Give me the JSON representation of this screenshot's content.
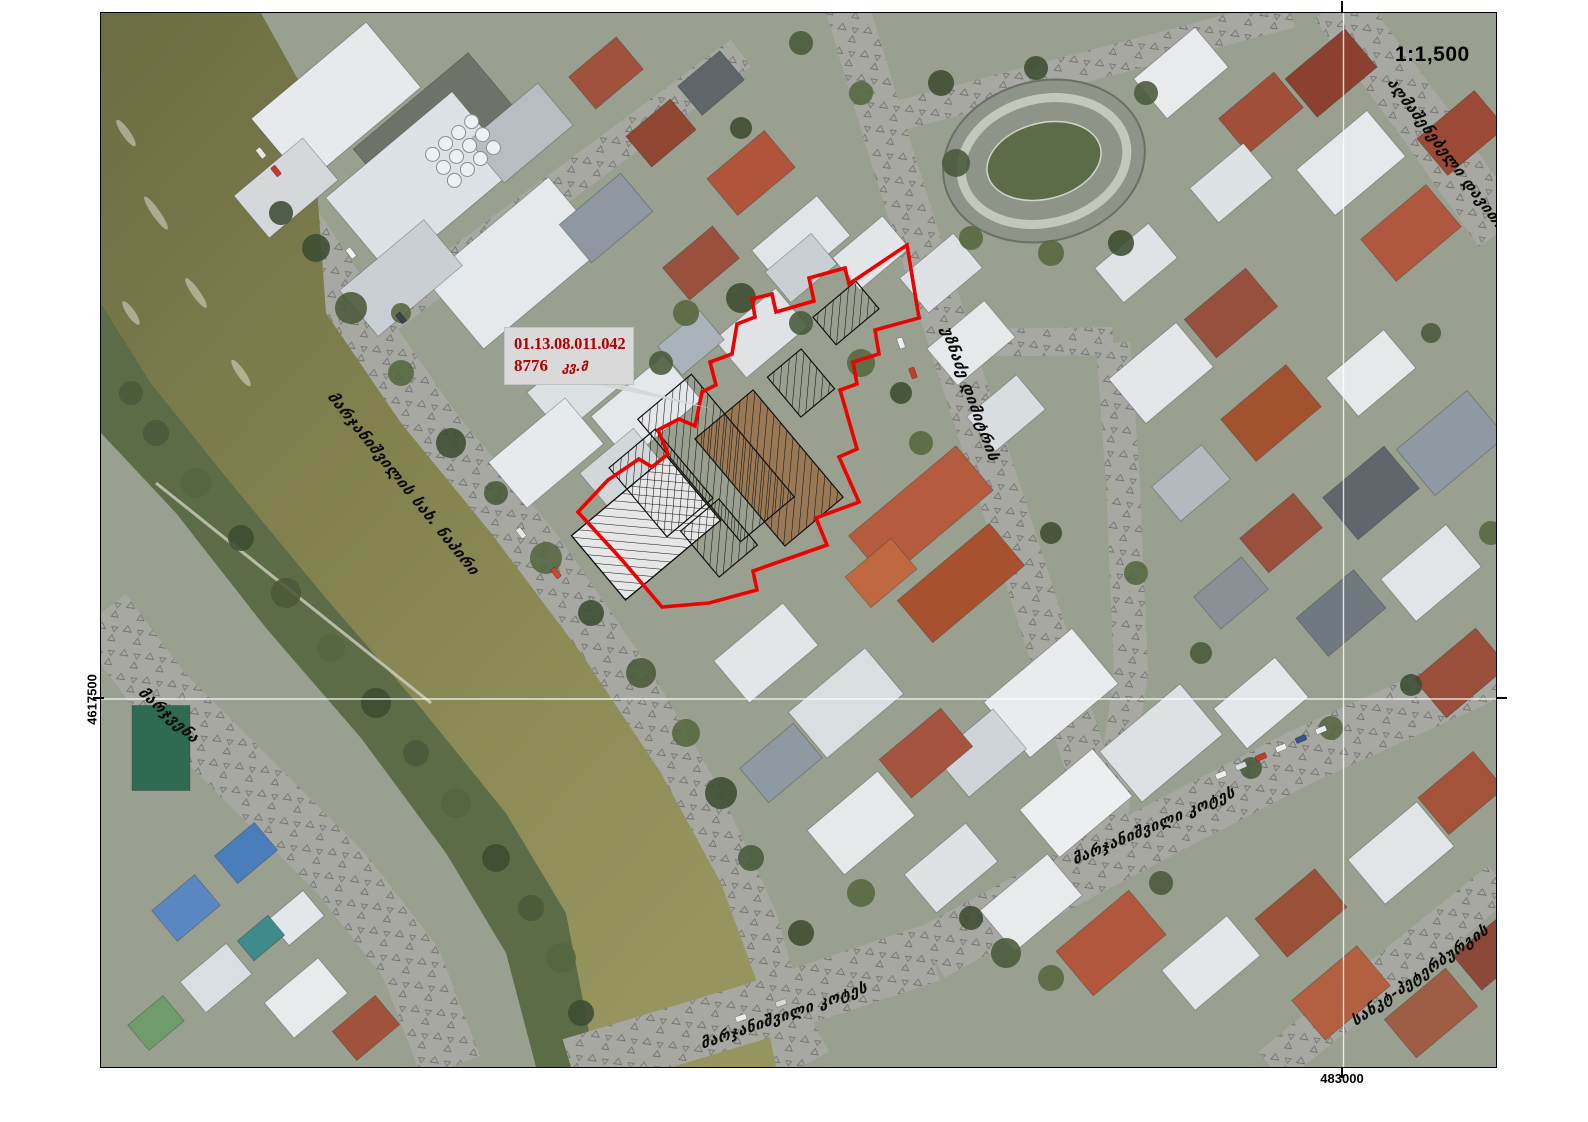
{
  "map": {
    "scale_label": "1:1,500",
    "type_label": "orthophoto cadastral map"
  },
  "parcel": {
    "code": "01.13.08.011.042",
    "area": "8776",
    "area_unit": "კვ.მ",
    "boundary_color": "#ee0000",
    "label_bg": "#d9d9d9",
    "label_text_color": "#b40000"
  },
  "grid": {
    "northing_label": "4617500",
    "easting_label": "483000"
  },
  "streets": {
    "embankment": "მარჯანიშვილის სახ. ნაპირი",
    "right_bank": "მარჯვენა",
    "uznadze": "უზნაძე დიმიტრის",
    "marjanishvili": "მარჯანიშვილი კოტეს",
    "marjanishvili_bridge": "მარჯანიშვილი კოტეს",
    "sankt_petersburg": "სანკტ-პეტერბურგის",
    "aghmashenebeli": "აღმაშენებელი დავითის"
  }
}
